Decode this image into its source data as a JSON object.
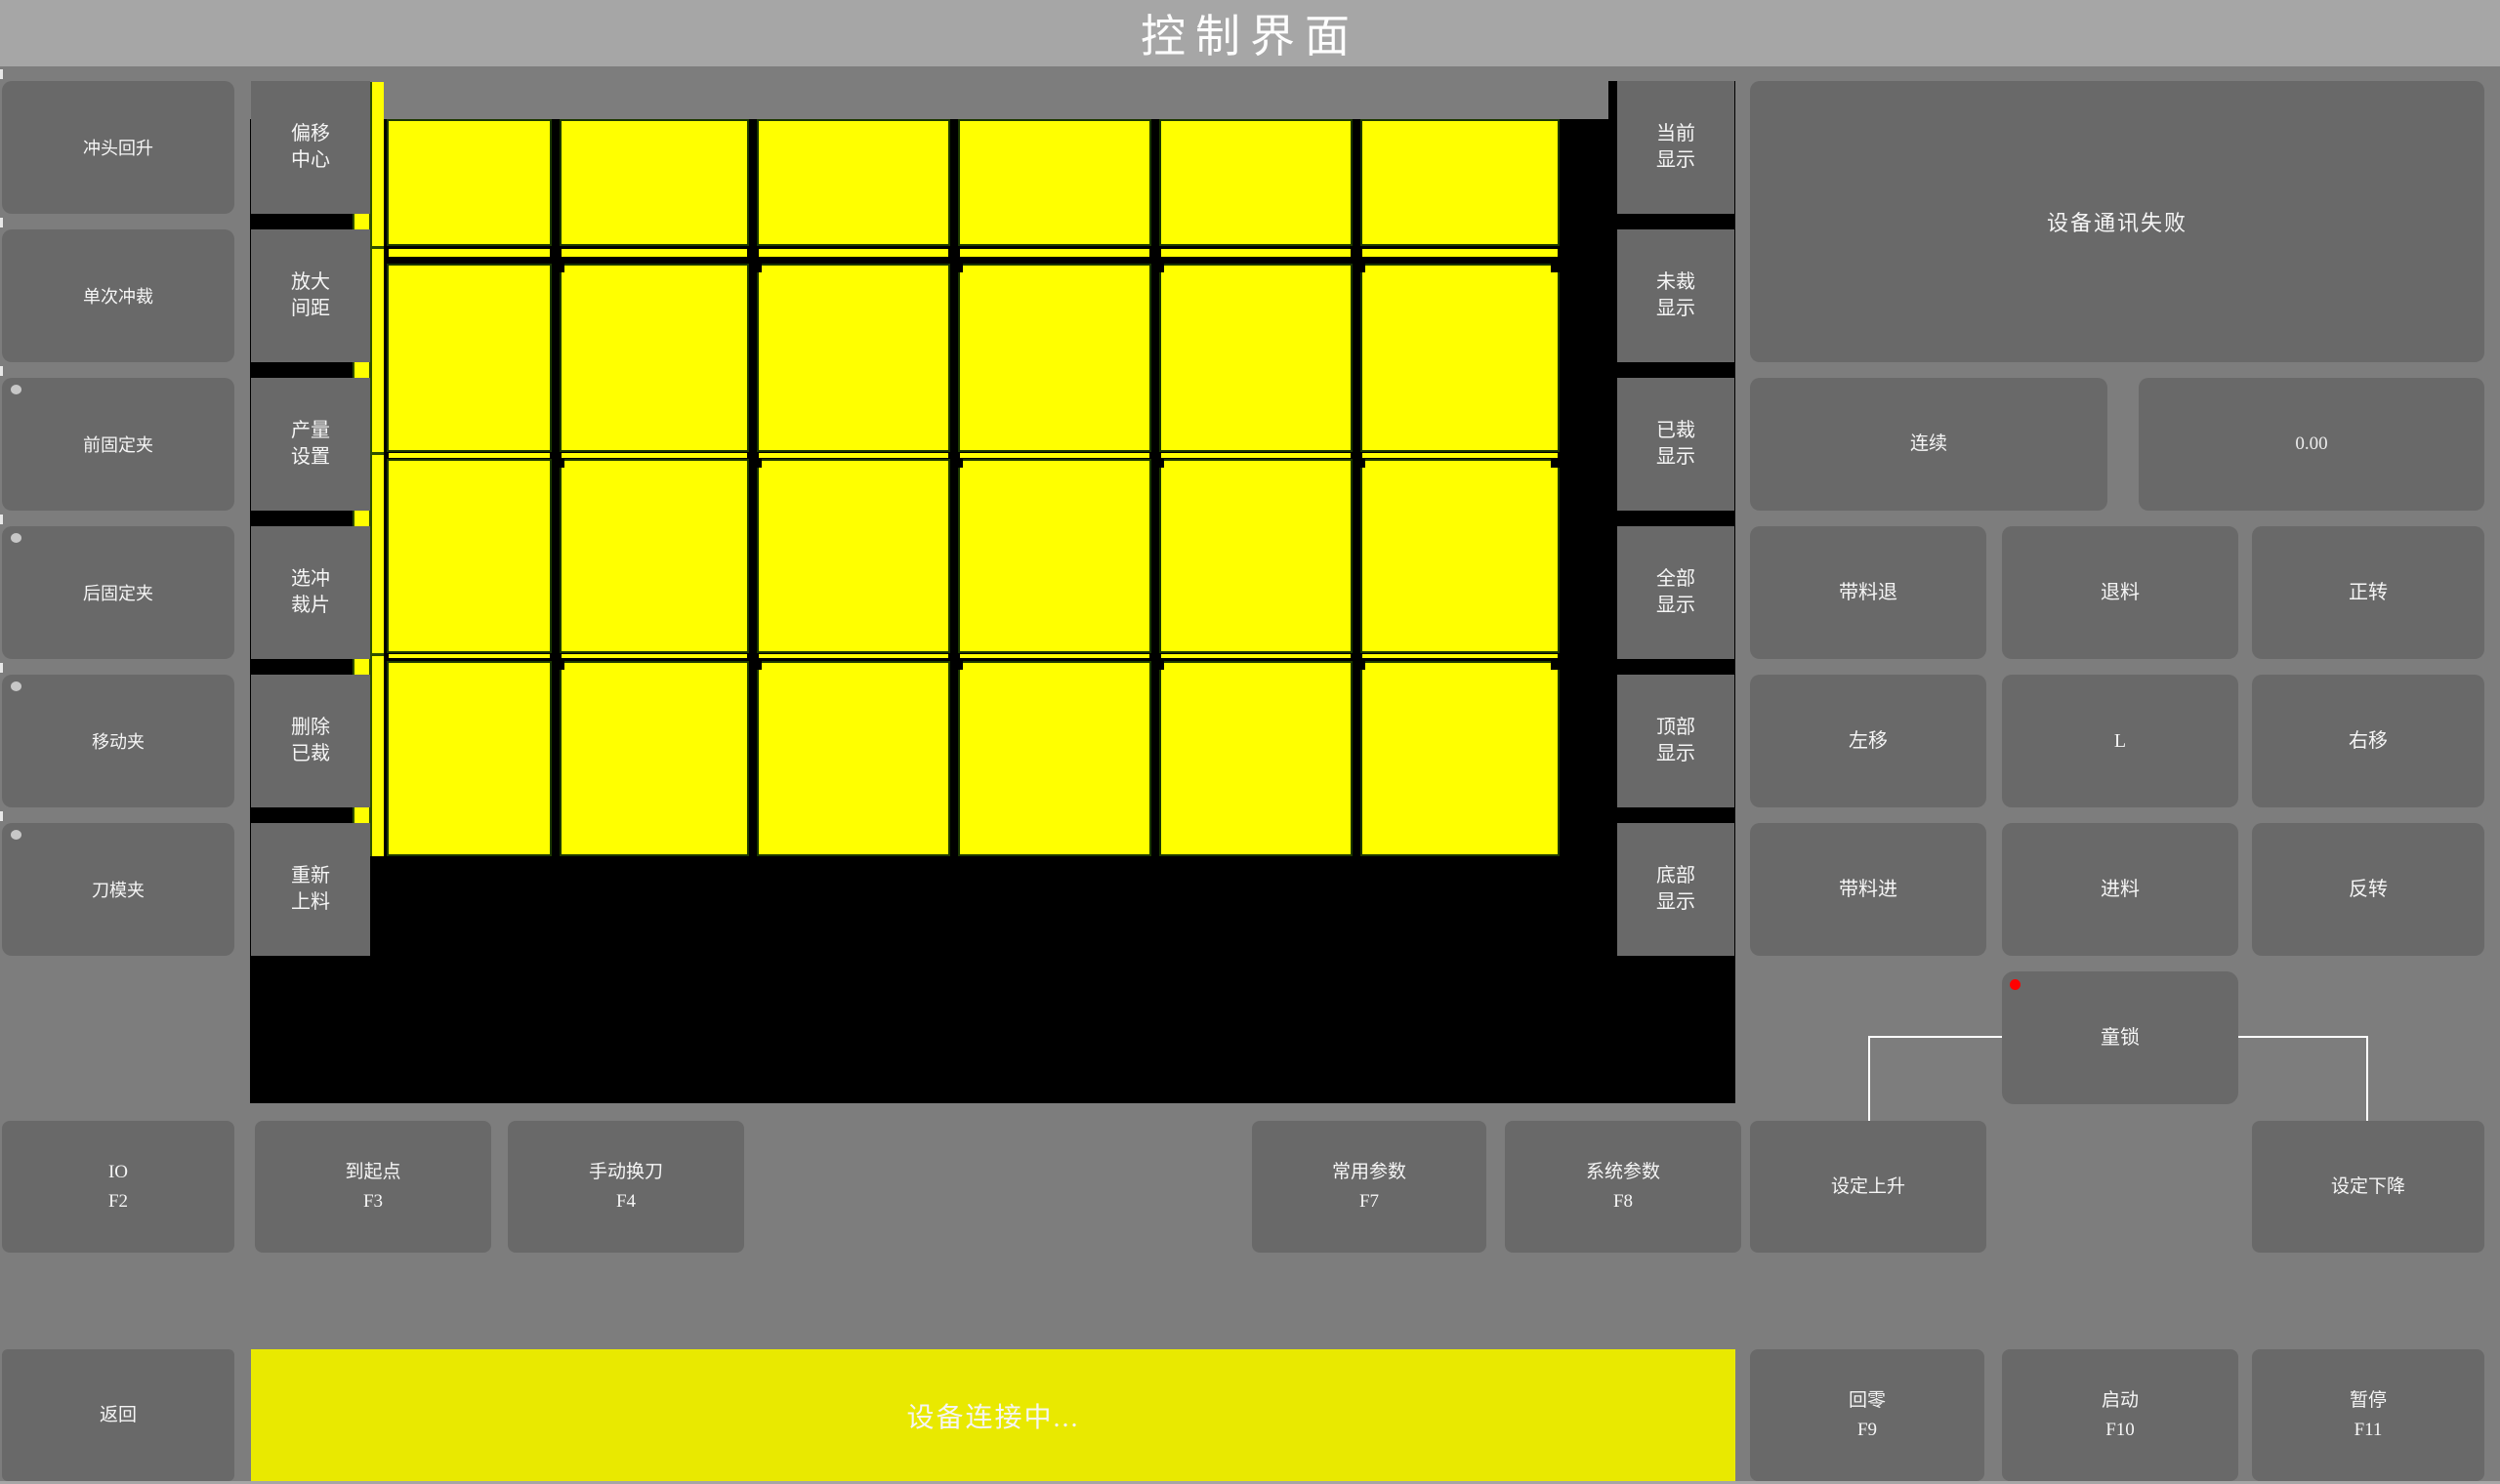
{
  "title": "控制界面",
  "left_panel": {
    "buttons": [
      {
        "label": "冲头回升",
        "indicator": false
      },
      {
        "label": "单次冲裁",
        "indicator": false
      },
      {
        "label": "前固定夹",
        "indicator": true
      },
      {
        "label": "后固定夹",
        "indicator": true
      },
      {
        "label": "移动夹",
        "indicator": true
      },
      {
        "label": "刀模夹",
        "indicator": true
      }
    ]
  },
  "tool_panel": {
    "buttons": [
      {
        "line1": "偏移",
        "line2": "中心"
      },
      {
        "line1": "放大",
        "line2": "间距"
      },
      {
        "line1": "产量",
        "line2": "设置"
      },
      {
        "line1": "选冲",
        "line2": "裁片"
      },
      {
        "line1": "删除",
        "line2": "已裁"
      },
      {
        "line1": "重新",
        "line2": "上料"
      }
    ]
  },
  "display_panel": {
    "buttons": [
      {
        "line1": "当前",
        "line2": "显示"
      },
      {
        "line1": "未裁",
        "line2": "显示"
      },
      {
        "line1": "已裁",
        "line2": "显示"
      },
      {
        "line1": "全部",
        "line2": "显示"
      },
      {
        "line1": "顶部",
        "line2": "显示"
      },
      {
        "line1": "底部",
        "line2": "显示"
      }
    ]
  },
  "sheet": {
    "columns": 6,
    "rows": 4,
    "pieces": 24,
    "piece_color": "#ffff00",
    "background": "#000000"
  },
  "right_panel": {
    "message": "设备通讯失败",
    "mode_button": "连续",
    "value_display": "0.00",
    "jog_buttons": [
      "带料退",
      "退料",
      "正转",
      "左移",
      "L",
      "右移",
      "带料进",
      "进料",
      "反转"
    ],
    "child_lock": {
      "label": "童锁",
      "indicator_color": "#ff0000"
    }
  },
  "function_row": {
    "buttons": [
      {
        "label": "IO",
        "fkey": "F2"
      },
      {
        "label": "到起点",
        "fkey": "F3"
      },
      {
        "label": "手动换刀",
        "fkey": "F4"
      },
      {
        "label": "常用参数",
        "fkey": "F7"
      },
      {
        "label": "系统参数",
        "fkey": "F8"
      },
      {
        "label": "设定上升",
        "fkey": ""
      },
      {
        "label": "设定下降",
        "fkey": ""
      }
    ]
  },
  "bottom_bar": {
    "back_button": "返回",
    "status_message": "设备连接中...",
    "buttons": [
      {
        "label": "回零",
        "fkey": "F9"
      },
      {
        "label": "启动",
        "fkey": "F10"
      },
      {
        "label": "暂停",
        "fkey": "F11"
      }
    ]
  },
  "colors": {
    "piece_yellow": "#ffff00",
    "status_bar_yellow": "#e9e900",
    "alert_red": "#ff0000",
    "title_bar_gray": "#a6a6a6",
    "button_gray": "#696969"
  }
}
